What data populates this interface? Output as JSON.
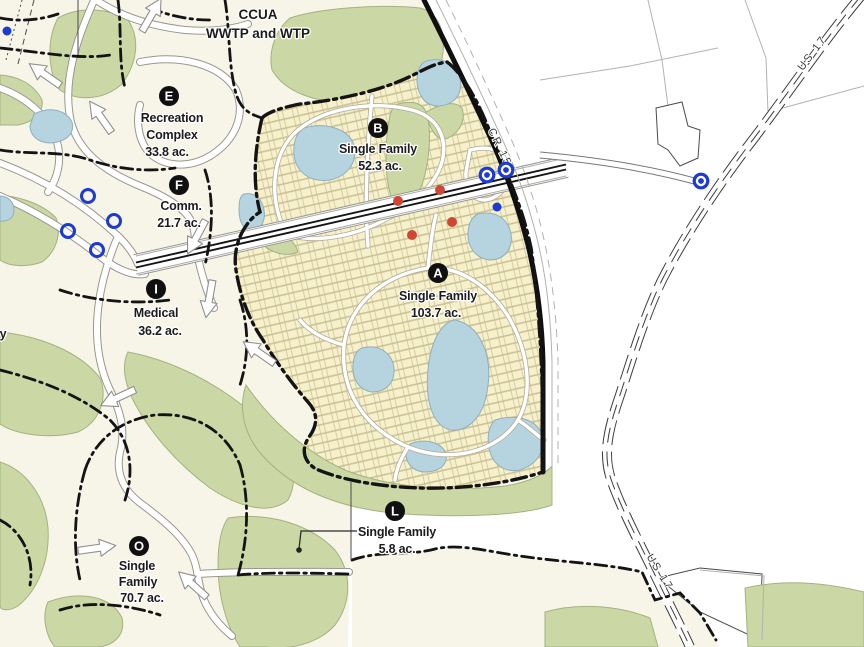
{
  "map": {
    "title": {
      "lines": [
        "CCUA",
        "WWTP and WTP"
      ]
    },
    "parcels": [
      {
        "id": "E",
        "lines": [
          "Recreation",
          "Complex"
        ],
        "acreage": "33.8 ac."
      },
      {
        "id": "F",
        "lines": [
          "Comm."
        ],
        "acreage": "21.7 ac."
      },
      {
        "id": "B",
        "lines": [
          "Single Family"
        ],
        "acreage": "52.3 ac."
      },
      {
        "id": "A",
        "lines": [
          "Single Family"
        ],
        "acreage": "103.7 ac."
      },
      {
        "id": "I",
        "lines": [
          "Medical"
        ],
        "acreage": "36.2 ac."
      },
      {
        "id": "O",
        "lines": [
          "Single",
          "Family"
        ],
        "acreage": "70.7 ac."
      },
      {
        "id": "L",
        "lines": [
          "Single Family"
        ],
        "acreage": "5.8 ac."
      }
    ],
    "road_labels": [
      {
        "text": "CR 15A"
      },
      {
        "text": "US 17"
      },
      {
        "text": "US 17"
      }
    ],
    "partial_label": {
      "text": "y"
    },
    "markers": {
      "blue_rings": [
        {
          "x": 88,
          "y": 196
        },
        {
          "x": 114,
          "y": 221
        },
        {
          "x": 68,
          "y": 231
        },
        {
          "x": 97,
          "y": 250
        }
      ],
      "blue_donuts": [
        {
          "x": 487,
          "y": 175
        },
        {
          "x": 506,
          "y": 170
        },
        {
          "x": 701,
          "y": 181
        }
      ],
      "blue_dots": [
        {
          "x": 7,
          "y": 31
        },
        {
          "x": 497,
          "y": 207
        }
      ],
      "red_dots": [
        {
          "x": 440,
          "y": 190
        },
        {
          "x": 398,
          "y": 201
        },
        {
          "x": 452,
          "y": 222
        },
        {
          "x": 412,
          "y": 235
        }
      ]
    },
    "arrows": [
      {
        "x": 44,
        "y": 74,
        "a": 215
      },
      {
        "x": 100,
        "y": 116,
        "a": 235
      },
      {
        "x": 152,
        "y": 14,
        "a": 300
      },
      {
        "x": 196,
        "y": 238,
        "a": 118
      },
      {
        "x": 209,
        "y": 300,
        "a": 100
      },
      {
        "x": 258,
        "y": 352,
        "a": 215
      },
      {
        "x": 117,
        "y": 398,
        "a": 155
      },
      {
        "x": 98,
        "y": 548,
        "a": 352
      },
      {
        "x": 192,
        "y": 584,
        "a": 222
      }
    ],
    "colors": {
      "cream": "#F7F4E8",
      "green": "#CBD8A5",
      "green_edge": "#A3B27E",
      "lot_fill": "#F6F0CB",
      "lot_line": "#C9BF94",
      "pond": "#B5D4E0",
      "pond_edge": "#90AFBC",
      "road_casing": "#9A978C",
      "boundary": "#141414",
      "blue": "#1E3BD1",
      "red": "#CE4733",
      "text": "#1C1C1C"
    }
  }
}
